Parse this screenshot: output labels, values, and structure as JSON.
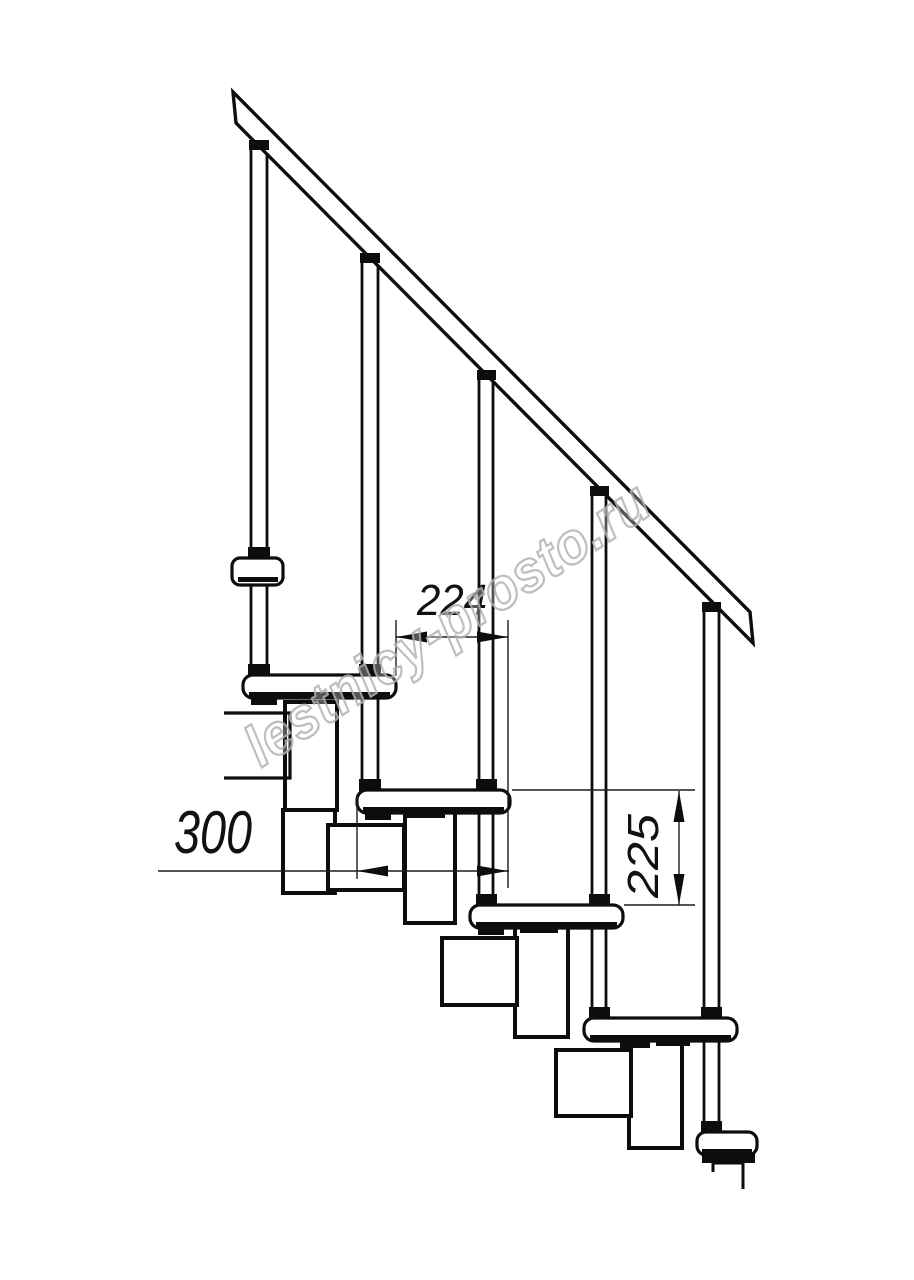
{
  "page": {
    "background_color": "#ffffff",
    "line_color": "#0d0d0d",
    "dim_color": "#1c1c1c"
  },
  "watermark": {
    "text": "lestnicy-prosto.ru",
    "color": "#b3b3b3"
  },
  "dimensions": [
    {
      "id": "step-run",
      "label": "224",
      "orientation": "horizontal"
    },
    {
      "id": "tread-depth",
      "label": "300",
      "orientation": "horizontal"
    },
    {
      "id": "step-rise",
      "label": "225",
      "orientation": "vertical"
    }
  ],
  "drawing": {
    "subject": "modular staircase side view",
    "tread_count": 6,
    "baluster_count": 5,
    "handrail_count": 1
  }
}
